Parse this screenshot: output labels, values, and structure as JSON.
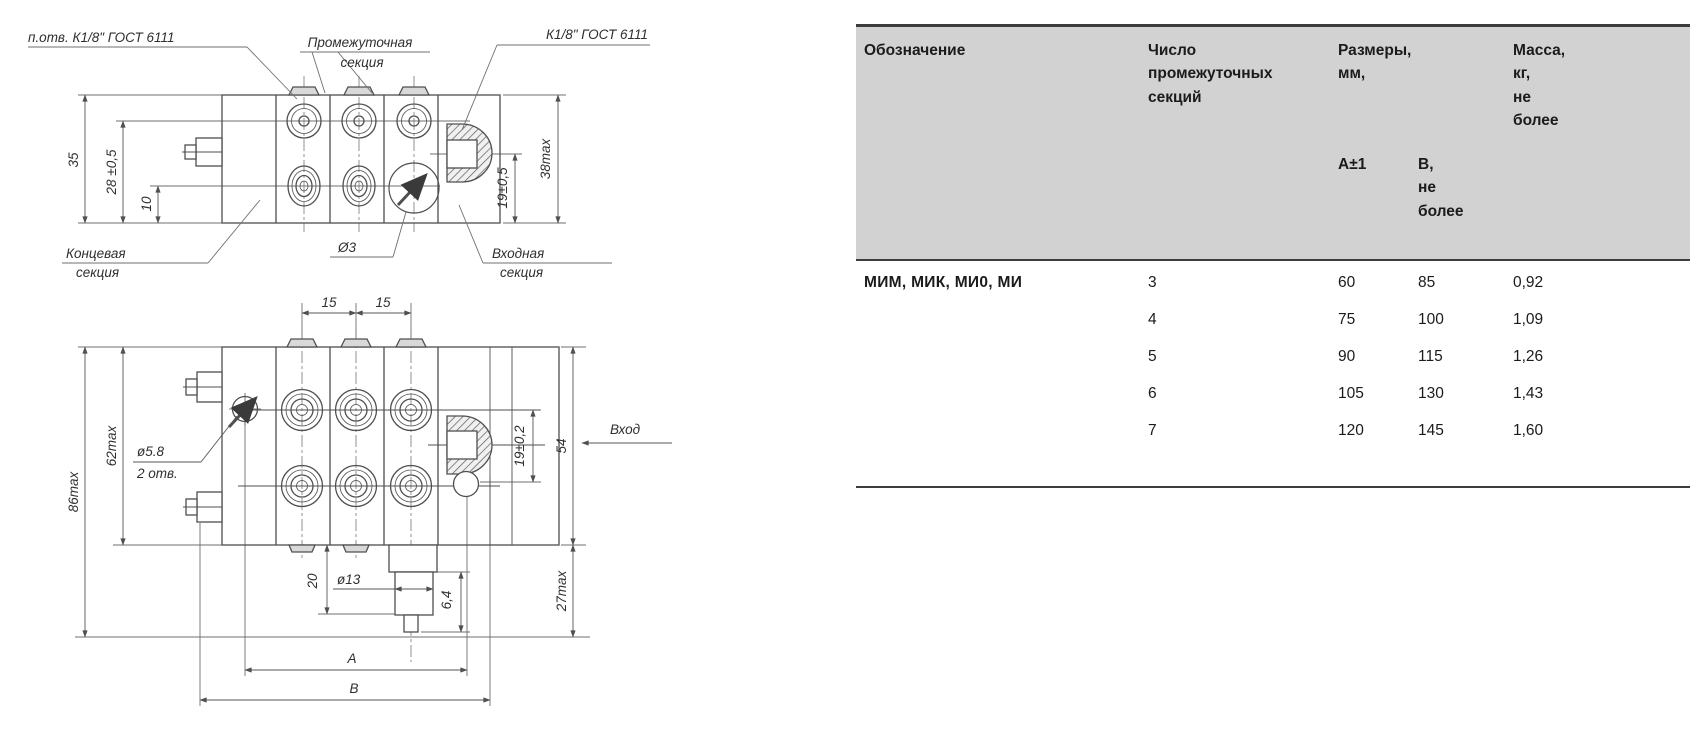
{
  "drawing": {
    "line_color": "#4f4f4f",
    "top_view": {
      "callouts": {
        "tap_hole_note": "п.отв. К1/8\" ГОСТ 6111",
        "intermediate_section_line1": "Промежуточная",
        "intermediate_section_line2": "секция",
        "inlet_thread_note": "К1/8\" ГОСТ 6111",
        "end_section_line1": "Концевая",
        "end_section_line2": "секция",
        "hole_dia_note": "Ø3",
        "inlet_section_line1": "Входная",
        "inlet_section_line2": "секция"
      },
      "dims": {
        "overall_height": "35",
        "upper_ports_height": "28 ±0,5",
        "lower_ports_height": "10",
        "inlet_port_height": "19±0,5",
        "max_height": "38max"
      }
    },
    "front_view": {
      "callouts": {
        "mount_hole_dia": "ø5.8",
        "mount_hole_qty": "2 отв.",
        "outlet_dia": "ø13",
        "inlet_flow_label": "Вход"
      },
      "dims": {
        "port_pitch_1": "15",
        "port_pitch_2": "15",
        "overall_height": "86max",
        "body_height": "62max",
        "inlet_offset": "19±0,2",
        "block_height": "54",
        "outlet_drop": "20",
        "tip_size": "6,4",
        "below_block_height": "27max",
        "dim_a_label": "A",
        "dim_b_label": "B"
      }
    }
  },
  "table": {
    "header": {
      "designation": "Обозначение",
      "sections": "Число\nпромежуточных\nсекций",
      "dimensions": "Размеры,\nмм,",
      "dim_a": "А±1",
      "dim_b": "В,\nне\nболее",
      "mass": "Масса,\nкг,\nне\nболее"
    },
    "designation_value": "МИМ, МИК, МИ0, МИ",
    "rows": [
      {
        "sections": "3",
        "a": "60",
        "b": "85",
        "mass": "0,92"
      },
      {
        "sections": "4",
        "a": "75",
        "b": "100",
        "mass": "1,09"
      },
      {
        "sections": "5",
        "a": "90",
        "b": "115",
        "mass": "1,26"
      },
      {
        "sections": "6",
        "a": "105",
        "b": "130",
        "mass": "1,43"
      },
      {
        "sections": "7",
        "a": "120",
        "b": "145",
        "mass": "1,60"
      }
    ],
    "header_bg": "#d2d2d2",
    "border_color": "#3c3c3c"
  }
}
